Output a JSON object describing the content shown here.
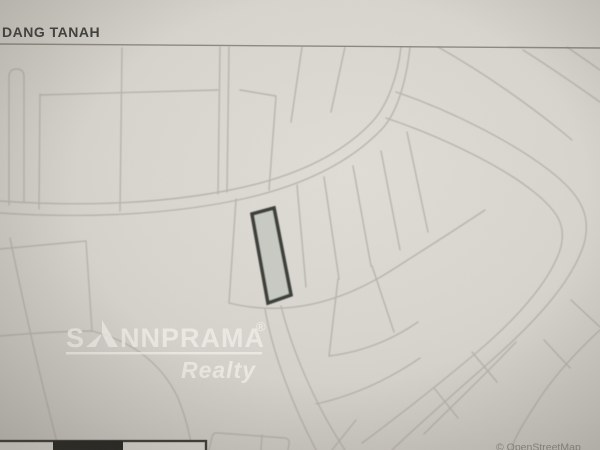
{
  "header": {
    "title": "DANG TANAH"
  },
  "watermark": {
    "brand_prefix": "S",
    "brand_suffix": "NNPRAMA",
    "registered_mark": "®",
    "subtitle": "Realty"
  },
  "map": {
    "attribution": "© OpenStreetMap"
  },
  "colors": {
    "paper": "#d7d4cd",
    "parcel_line": "#b2aea7",
    "header_text": "#3f3e3b",
    "header_divider": "#8b8881",
    "highlight_fill": "#c8cbc3",
    "highlight_stroke": "#3b3c39",
    "watermark_text": "#f1efe9",
    "attribution_text": "#8a8780",
    "scalebar_dark": "#23221e",
    "scalebar_border": "#3c3a36",
    "scalebar_light": "#d8d5ce"
  }
}
